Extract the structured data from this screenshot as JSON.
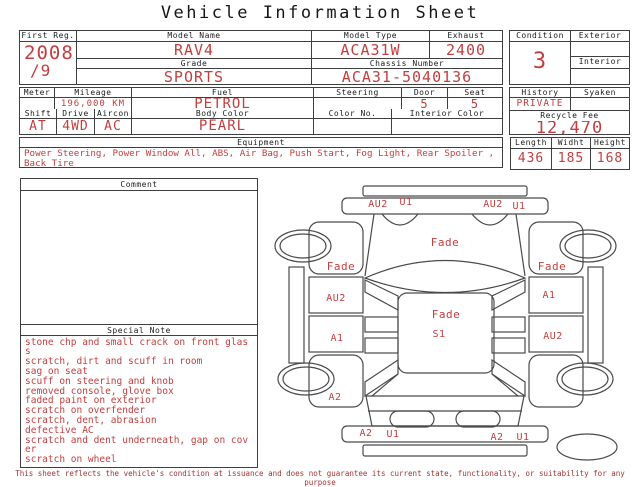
{
  "title": "Vehicle Information Sheet",
  "colors": {
    "accent_red": "#c33e3e",
    "footer_red": "#a23535",
    "border": "#3f3f3f"
  },
  "table1": {
    "first_reg_label": "First Reg.",
    "first_reg_value": "2008",
    "first_reg_value2": "/9",
    "model_name_label": "Model Name",
    "model_name": "RAV4",
    "grade_label": "Grade",
    "grade": "SPORTS",
    "model_type_label": "Model Type",
    "model_type": "ACA31W",
    "exhaust_label": "Exhaust",
    "exhaust": "2400",
    "chassis_label": "Chassis Number",
    "chassis": "ACA31-5040136",
    "condition_label": "Condition",
    "condition": "3",
    "exterior_label": "Exterior",
    "exterior": "",
    "interior_label": "Interior",
    "interior": ""
  },
  "table2": {
    "meter_label": "Meter",
    "meter": "",
    "mileage_label": "Mileage",
    "mileage": "196,000 KM",
    "fuel_label": "Fuel",
    "fuel": "PETROL",
    "steering_label": "Steering",
    "steering": "",
    "door_label": "Door",
    "door": "5",
    "seat_label": "Seat",
    "seat": "5",
    "shift_label": "Shift",
    "shift": "AT",
    "drive_label": "Drive",
    "drive": "4WD",
    "aircon_label": "Aircon",
    "aircon": "AC",
    "body_color_label": "Body Color",
    "body_color": "PEARL",
    "color_no_label": "Color No.",
    "color_no": "",
    "interior_color_label": "Interior Color",
    "interior_color": "",
    "history_label": "History",
    "history": "PRIVATE",
    "syaken_label": "Syaken",
    "syaken": "",
    "recycle_fee_label": "Recycle Fee",
    "recycle_fee": "12,470"
  },
  "equipment": {
    "label": "Equipment",
    "text": "Power Steering, Power Window  All, ABS, Air Bag, Push Start, Fog Light, Rear Spoiler , Back Tire"
  },
  "dimensions": {
    "length_label": "Length",
    "length": "436",
    "width_label": "Widht",
    "width": "185",
    "height_label": "Height",
    "height": "168"
  },
  "comment": {
    "label": "Comment",
    "text": ""
  },
  "special_note": {
    "label": "Special Note",
    "notes": [
      "stone chp and small crack on front glass",
      "scratch, dirt and scuff in room",
      "sag on seat",
      "scuff on steering and knob",
      "removed console, glove box",
      "faded paint on exterior",
      "scratch on overfender",
      "scratch, dent, abrasion",
      "defective AC",
      "scratch and dent underneath, gap on cover",
      "scratch on wheel"
    ]
  },
  "diagram": {
    "labels": {
      "front_bumper_left_a": "AU2",
      "front_bumper_left_b": "U1",
      "front_bumper_right_a": "AU2",
      "front_bumper_right_b": "U1",
      "hood": "Fade",
      "left_fender": "Fade",
      "right_fender": "Fade",
      "left_front_door": "AU2",
      "right_front_door": "A1",
      "roof": "Fade",
      "roof_center": "S1",
      "left_rear_door": "A1",
      "right_rear_door": "AU2",
      "left_rear_fender": "A2",
      "rear_bumper_left_a": "A2",
      "rear_bumper_left_b": "U1",
      "rear_bumper_right_a": "A2",
      "rear_bumper_right_b": "U1"
    }
  },
  "footer": {
    "text": "This sheet reflects the vehicle's condition at issuance and does not guarantee its current state, functionality, or suitability for any purpose"
  }
}
